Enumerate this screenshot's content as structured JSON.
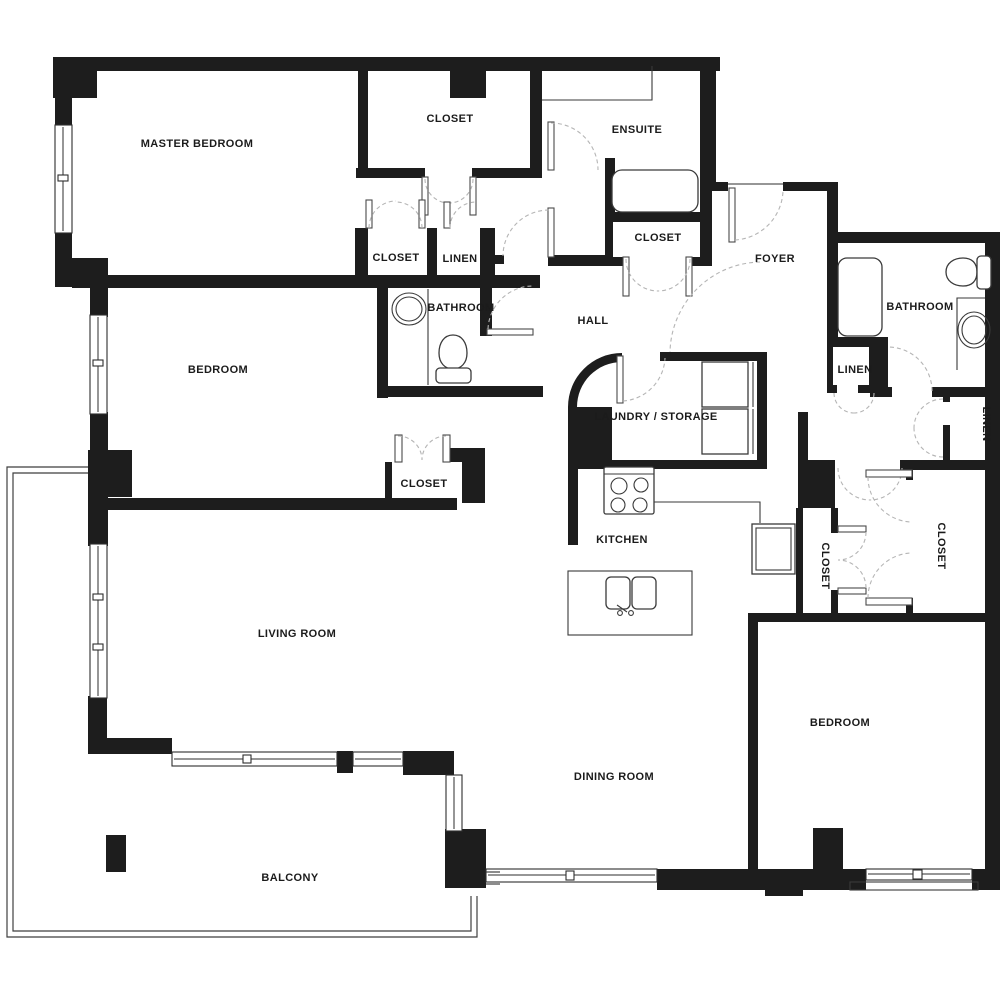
{
  "floorplan": {
    "type": "apartment-floor-plan",
    "wall_color": "#1d1d1d",
    "background_color": "#ffffff",
    "door_arc_color": "#b5b5b5"
  },
  "rooms": [
    {
      "id": "master-bedroom",
      "label": "MASTER BEDROOM"
    },
    {
      "id": "closet-top",
      "label": "CLOSET"
    },
    {
      "id": "ensuite",
      "label": "ENSUITE"
    },
    {
      "id": "closet-hall",
      "label": "CLOSET"
    },
    {
      "id": "linen-hall",
      "label": "LINEN"
    },
    {
      "id": "bathroom-left",
      "label": "BATHROOM"
    },
    {
      "id": "hall",
      "label": "HALL"
    },
    {
      "id": "closet-ensuite",
      "label": "CLOSET"
    },
    {
      "id": "foyer",
      "label": "FOYER"
    },
    {
      "id": "bathroom-right",
      "label": "BATHROOM"
    },
    {
      "id": "linen-right",
      "label": "LINEN"
    },
    {
      "id": "linen-vertical",
      "label": "LINEN"
    },
    {
      "id": "laundry-storage",
      "label": "LAUNDRY / STORAGE"
    },
    {
      "id": "kitchen",
      "label": "KITCHEN"
    },
    {
      "id": "closet-vertical-left",
      "label": "CLOSET"
    },
    {
      "id": "closet-vertical-right",
      "label": "CLOSET"
    },
    {
      "id": "bedroom-left",
      "label": "BEDROOM"
    },
    {
      "id": "closet-bedroom",
      "label": "CLOSET"
    },
    {
      "id": "living-room",
      "label": "LIVING ROOM"
    },
    {
      "id": "dining-room",
      "label": "DINING ROOM"
    },
    {
      "id": "bedroom-right",
      "label": "BEDROOM"
    },
    {
      "id": "balcony",
      "label": "BALCONY"
    }
  ],
  "fixtures": [
    "bathtub-ensuite",
    "bathtub-right-bathroom",
    "toilet-left-bathroom",
    "toilet-right-bathroom",
    "sink-left-bathroom",
    "sink-right-bathroom",
    "vanity-ensuite",
    "stove",
    "kitchen-island-sink",
    "fridge",
    "washer",
    "dryer",
    "balcony-column",
    "structural-pillar"
  ]
}
